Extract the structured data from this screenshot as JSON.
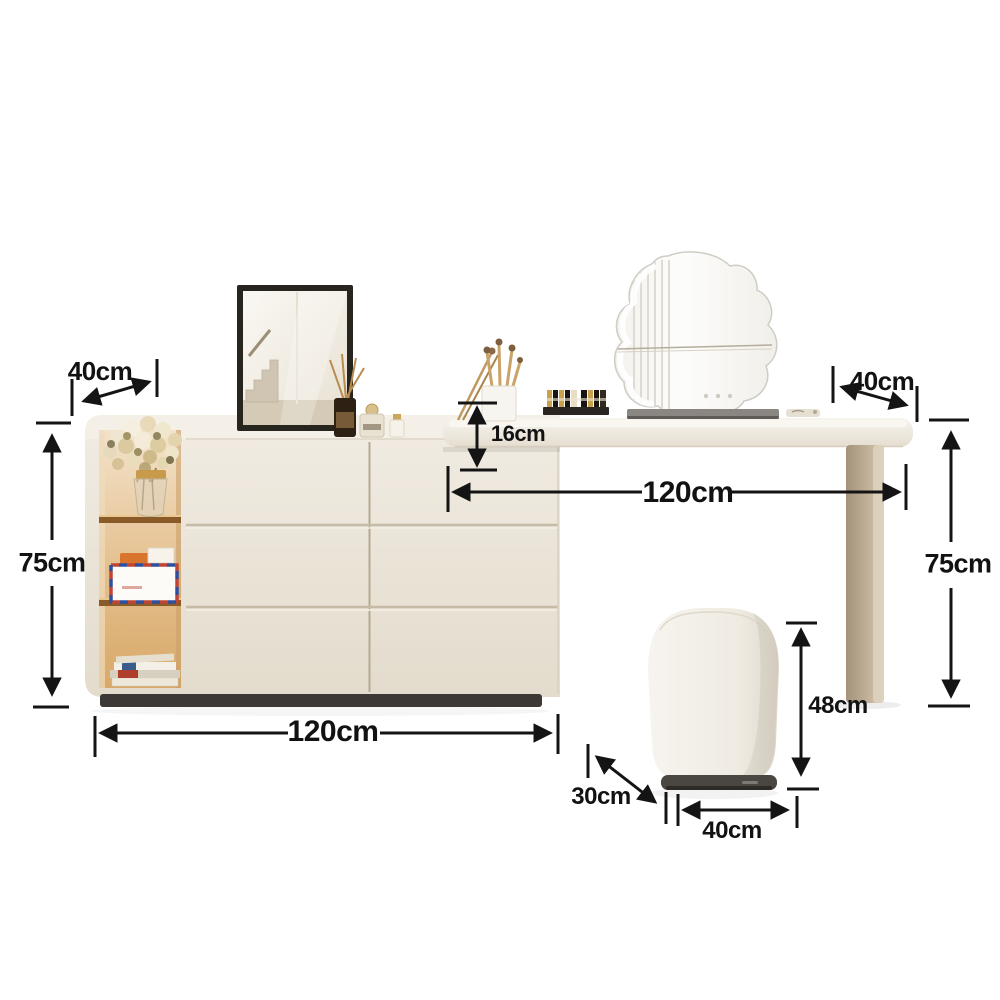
{
  "page": {
    "background": "#ffffff",
    "kind": "product-dimension-diagram",
    "subject": "vanity dressing table with drawer cabinet, mirrors and stool"
  },
  "dimensions": {
    "cabinet_depth": "40cm",
    "cabinet_height": "75cm",
    "cabinet_length": "120cm",
    "desk_overhang": "16cm",
    "desk_length": "120cm",
    "desk_depth": "40cm",
    "desk_height": "75cm",
    "stool_height": "48cm",
    "stool_depth": "30cm",
    "stool_width": "40cm"
  },
  "colors": {
    "annotation": "#141414",
    "cabinet_cream": "#ebe5da",
    "desk_cream": "#f2eee6",
    "leg_tan": "#bfae97",
    "shelf_glow": "#d8a969",
    "plinth_dark": "#3b3835",
    "stool_base_dark": "#4a4641",
    "mirror_frame": "#28251f"
  }
}
